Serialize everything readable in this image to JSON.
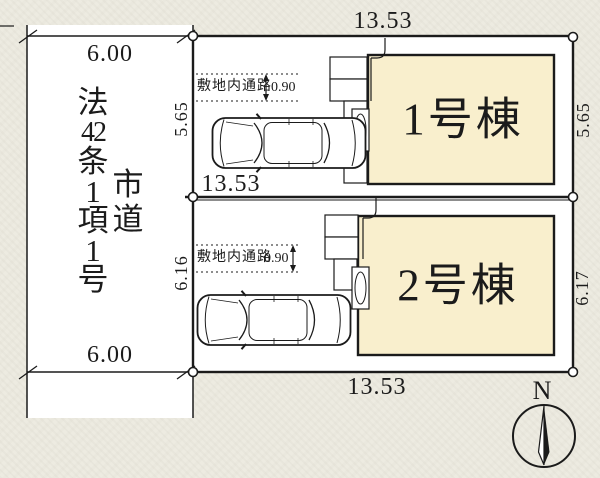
{
  "road": {
    "classification_chars": [
      "法",
      "42",
      "条",
      "1",
      "項",
      "1",
      "号"
    ],
    "type_chars": [
      "市",
      "道"
    ],
    "width_top": "6.00",
    "width_bottom": "6.00"
  },
  "site": {
    "frontage_top": "13.53",
    "frontage_middle": "13.53",
    "frontage_bottom": "13.53",
    "lot1": {
      "building_label": "1号棟",
      "depth_left": "5.65",
      "depth_right": "5.65",
      "passage_label": "敷地内通路",
      "passage_width": "0.90"
    },
    "lot2": {
      "building_label": "2号棟",
      "depth_left": "6.16",
      "depth_right": "6.17",
      "passage_label": "敷地内通路",
      "passage_width": "0.90"
    }
  },
  "compass": {
    "label": "N"
  },
  "colors": {
    "background": "#edebe1",
    "paper": "#ffffff",
    "building_fill": "#f9efcd",
    "line": "#1b1b1b"
  }
}
